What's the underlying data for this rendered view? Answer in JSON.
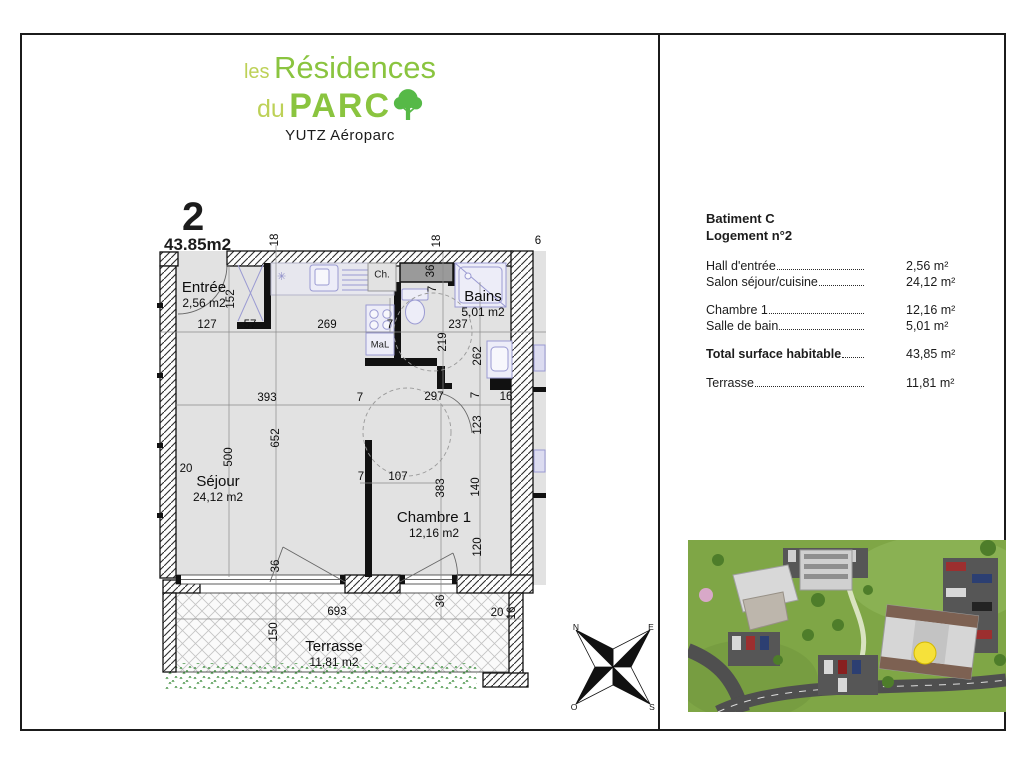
{
  "logo": {
    "les": "les",
    "residences": "Résidences",
    "du": "du",
    "parc": "PARC",
    "subtitle": "YUTZ Aéroparc",
    "light_green": "#bdd157",
    "green": "#8ac43f",
    "tree_green": "#56b947"
  },
  "floor_plan": {
    "unit_number": "2",
    "unit_area": "43.85m2",
    "rooms": [
      {
        "name": "Entrée",
        "area": "2,56 m2",
        "x": 54,
        "y": 84
      },
      {
        "name": "Séjour",
        "area": "24,12 m2",
        "x": 68,
        "y": 278
      },
      {
        "name": "Bains",
        "area": "5,01 m2",
        "x": 333,
        "y": 93
      },
      {
        "name": "Chambre 1",
        "area": "12,16 m2",
        "x": 284,
        "y": 314
      },
      {
        "name": "Terrasse",
        "area": "11,81 m2",
        "x": 184,
        "y": 443
      }
    ],
    "fixtures": {
      "water_heater": "Ch.",
      "washing_machine": "MaL"
    },
    "dimensions": [
      {
        "t": "18",
        "x": 125,
        "y": 45,
        "r": 1
      },
      {
        "t": "18",
        "x": 287,
        "y": 46,
        "r": 1
      },
      {
        "t": "6",
        "x": 388,
        "y": 46
      },
      {
        "t": "152",
        "x": 81,
        "y": 104,
        "r": 1
      },
      {
        "t": "127",
        "x": 57,
        "y": 130
      },
      {
        "t": "57",
        "x": 100,
        "y": 130
      },
      {
        "t": "269",
        "x": 177,
        "y": 130
      },
      {
        "t": "7",
        "x": 240,
        "y": 130
      },
      {
        "t": "237",
        "x": 308,
        "y": 130
      },
      {
        "t": "219",
        "x": 293,
        "y": 147,
        "r": 1
      },
      {
        "t": "262",
        "x": 328,
        "y": 161,
        "r": 1
      },
      {
        "t": "36",
        "x": 281,
        "y": 76,
        "r": 1
      },
      {
        "t": "7",
        "x": 283,
        "y": 94,
        "r": 1
      },
      {
        "t": "393",
        "x": 117,
        "y": 203
      },
      {
        "t": "7",
        "x": 210,
        "y": 203
      },
      {
        "t": "297",
        "x": 284,
        "y": 202
      },
      {
        "t": "7",
        "x": 326,
        "y": 200,
        "r": 1
      },
      {
        "t": "16",
        "x": 356,
        "y": 202
      },
      {
        "t": "652",
        "x": 126,
        "y": 243,
        "r": 1
      },
      {
        "t": "500",
        "x": 79,
        "y": 262,
        "r": 1
      },
      {
        "t": "20",
        "x": 36,
        "y": 274
      },
      {
        "t": "7",
        "x": 211,
        "y": 282
      },
      {
        "t": "107",
        "x": 248,
        "y": 282
      },
      {
        "t": "383",
        "x": 291,
        "y": 293,
        "r": 1
      },
      {
        "t": "123",
        "x": 328,
        "y": 230,
        "r": 1
      },
      {
        "t": "140",
        "x": 326,
        "y": 292,
        "r": 1
      },
      {
        "t": "120",
        "x": 328,
        "y": 352,
        "r": 1
      },
      {
        "t": "36",
        "x": 126,
        "y": 371,
        "r": 1
      },
      {
        "t": "36",
        "x": 291,
        "y": 406,
        "r": 1
      },
      {
        "t": "693",
        "x": 187,
        "y": 417
      },
      {
        "t": "150",
        "x": 124,
        "y": 437,
        "r": 1
      },
      {
        "t": "20",
        "x": 347,
        "y": 418
      },
      {
        "t": "16",
        "x": 362,
        "y": 418,
        "r": 1
      }
    ],
    "compass": {
      "north": "N",
      "east": "E",
      "west": "O",
      "south": "S"
    }
  },
  "details_panel": {
    "building": "Batiment C",
    "unit": "Logement n°2",
    "rows": [
      {
        "label": "Hall d'entrée",
        "value": "2,56 m²",
        "bold": false,
        "spacer": false
      },
      {
        "label": "Salon séjour/cuisine",
        "value": "24,12 m²",
        "bold": false,
        "spacer": false
      },
      {
        "label": "Chambre 1",
        "value": "12,16 m²",
        "bold": false,
        "spacer": true
      },
      {
        "label": "Salle de bain",
        "value": "5,01 m²",
        "bold": false,
        "spacer": false
      },
      {
        "label": "Total surface habitable",
        "value": "43,85 m²",
        "bold": true,
        "spacer": true
      },
      {
        "label": "Terrasse",
        "value": "11,81 m²",
        "bold": false,
        "spacer": true
      }
    ]
  }
}
